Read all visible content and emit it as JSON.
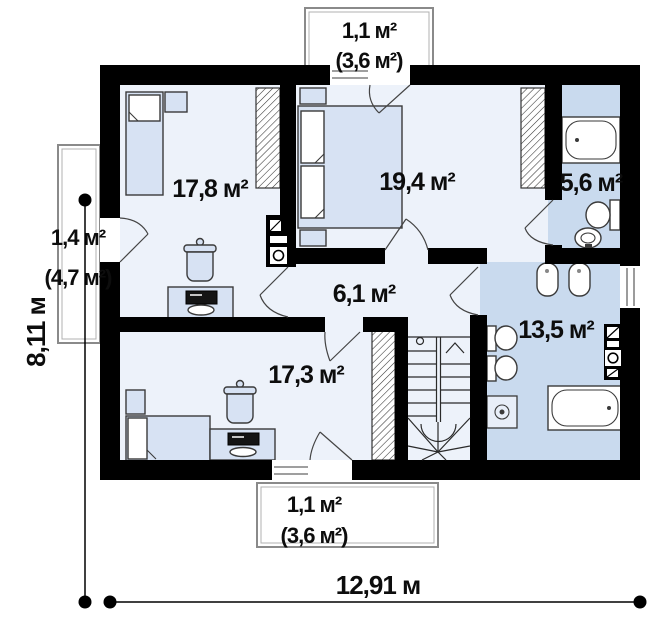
{
  "plan": {
    "rooms": [
      {
        "name": "bedroom-1",
        "label": "17,8 м²"
      },
      {
        "name": "bedroom-2",
        "label": "19,4 м²"
      },
      {
        "name": "bathroom-small",
        "label": "5,6 м²"
      },
      {
        "name": "hallway",
        "label": "6,1 м²"
      },
      {
        "name": "bathroom-large",
        "label": "13,5 м²"
      },
      {
        "name": "bedroom-3",
        "label": "17,3 м²"
      }
    ],
    "balconies": [
      {
        "name": "balcony-top",
        "area": "1,1 м²",
        "area_total": "(3,6 м²)"
      },
      {
        "name": "balcony-left",
        "area": "1,4 м²",
        "area_total": "(4,7 м²)"
      },
      {
        "name": "balcony-bottom",
        "area": "1,1 м²",
        "area_total": "(3,6 м²)"
      }
    ],
    "dimensions": {
      "vertical": "8,11 м",
      "horizontal": "12,91 м"
    },
    "colors": {
      "wall": "#000000",
      "room_floor": "#edf2fa",
      "bath_floor": "#c9daee",
      "furniture_fill": "#d7e2f3",
      "outline": "#3a3a3a"
    }
  }
}
